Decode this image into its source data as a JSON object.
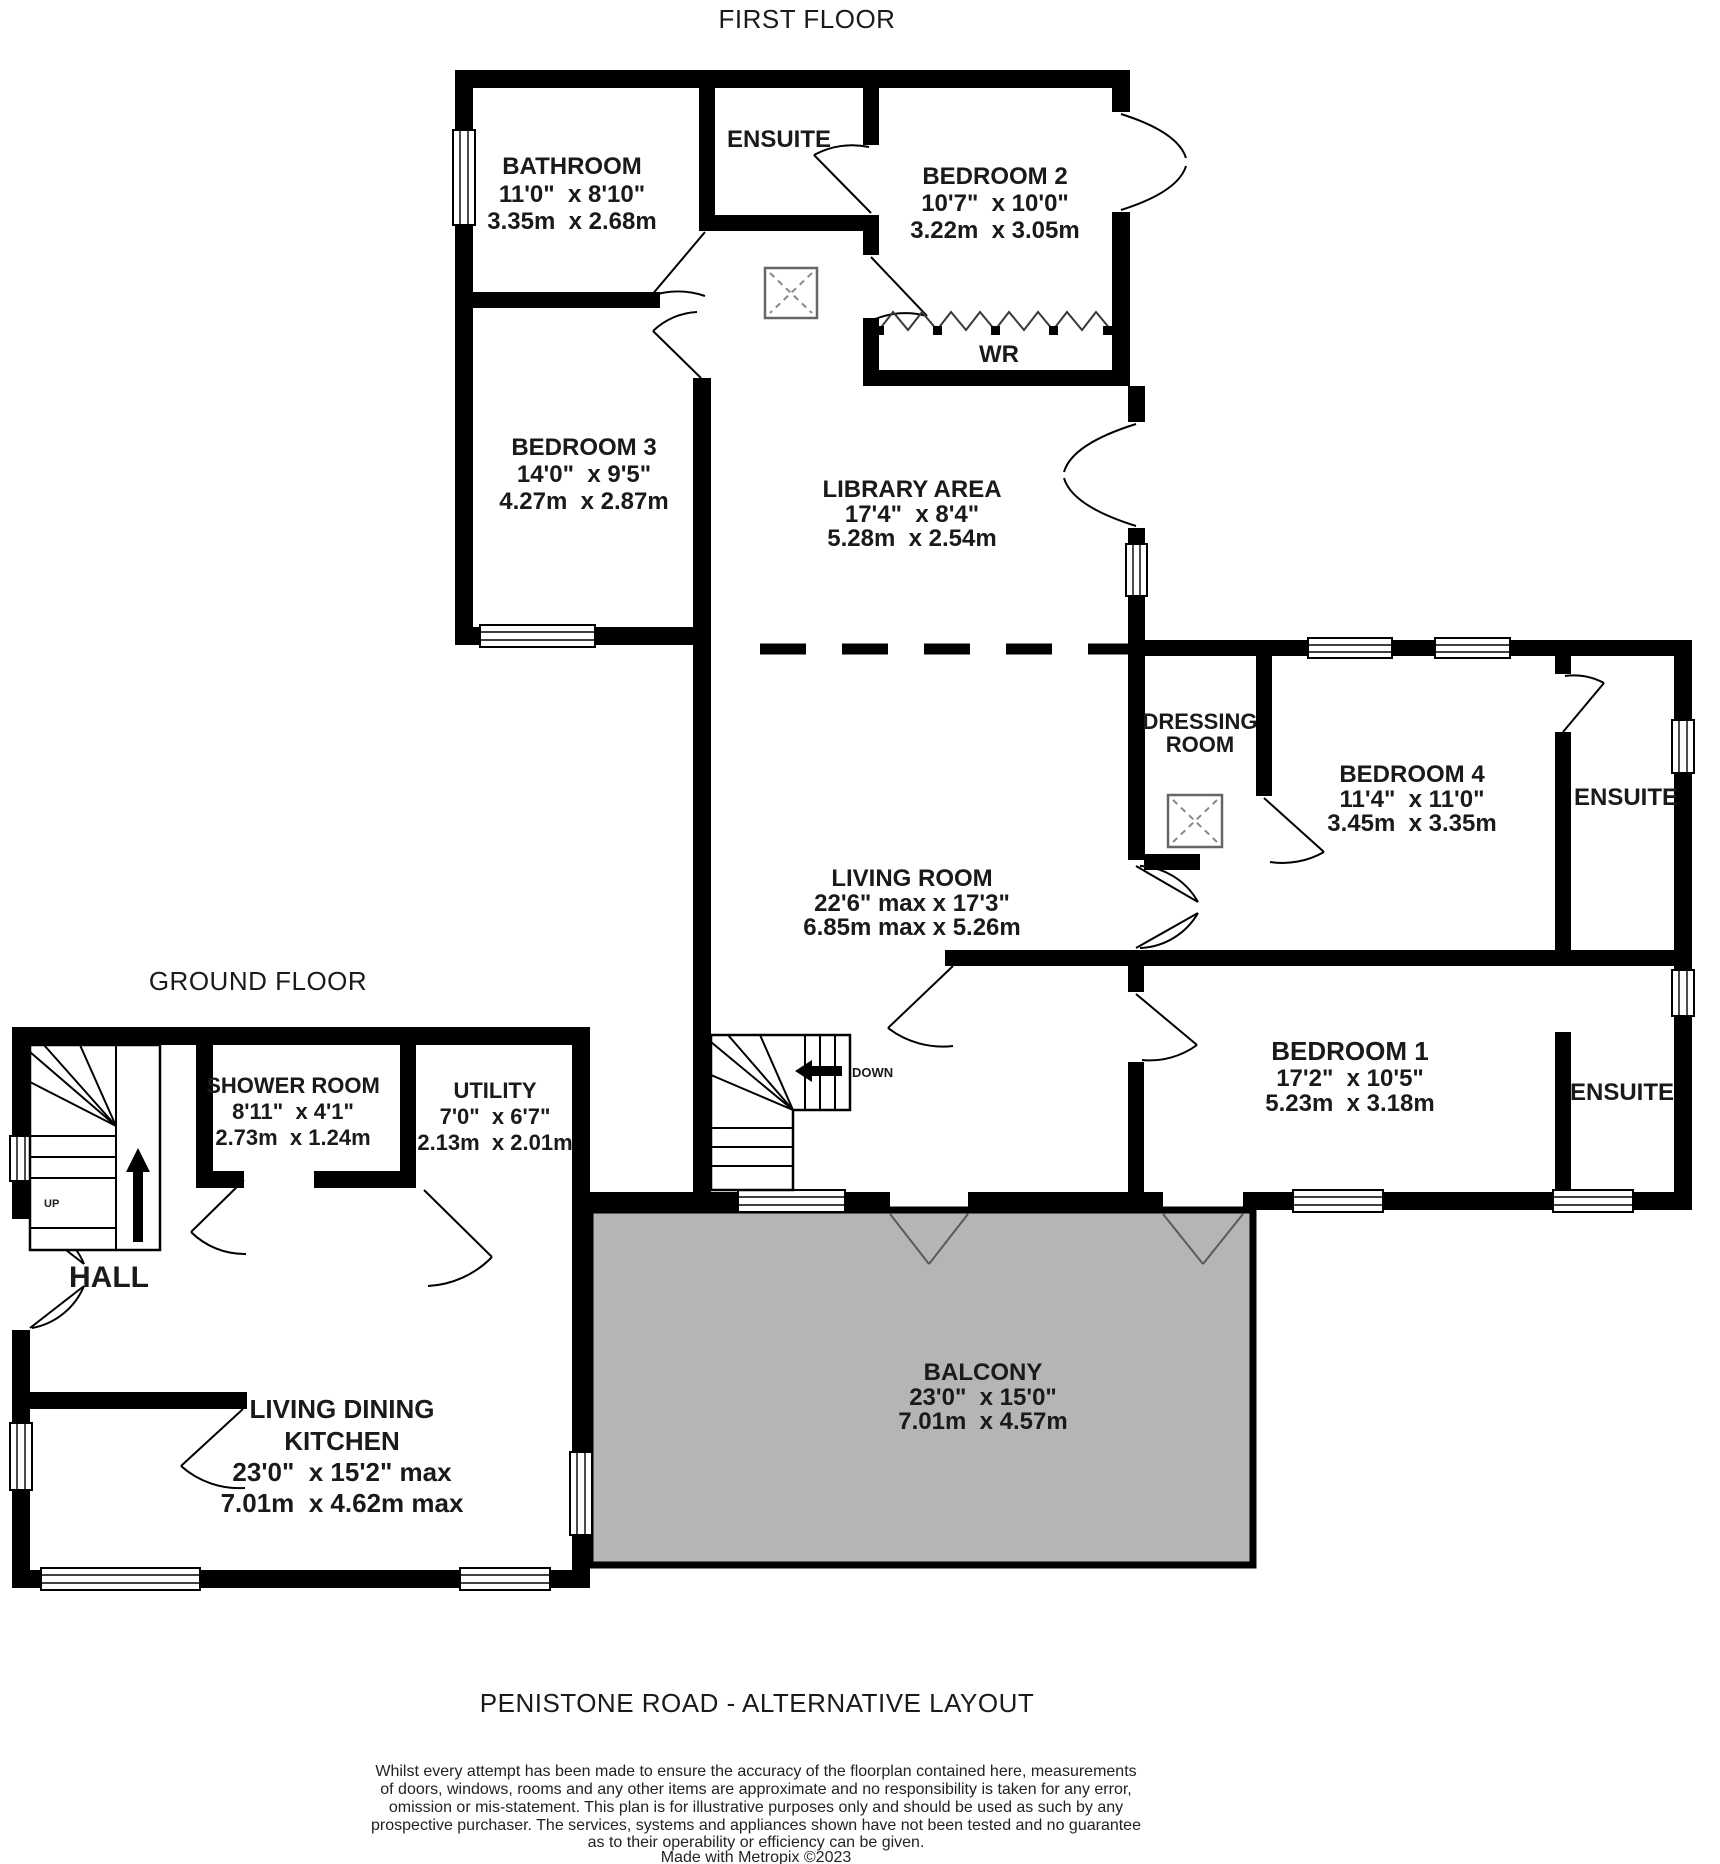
{
  "title": "PENISTONE ROAD - ALTERNATIVE LAYOUT",
  "credit": "Made with Metropix ©2023",
  "floors": {
    "first": {
      "label": "FIRST FLOOR"
    },
    "ground": {
      "label": "GROUND FLOOR"
    }
  },
  "rooms": {
    "bathroom": {
      "name": "BATHROOM",
      "ft": "11'0\"  x 8'10\"",
      "m": "3.35m  x 2.68m"
    },
    "ensuite_top": {
      "name": "ENSUITE"
    },
    "bedroom2": {
      "name": "BEDROOM 2",
      "ft": "10'7\"  x 10'0\"",
      "m": "3.22m  x 3.05m"
    },
    "wr": {
      "name": "WR"
    },
    "bedroom3": {
      "name": "BEDROOM 3",
      "ft": "14'0\"  x 9'5\"",
      "m": "4.27m  x 2.87m"
    },
    "library": {
      "name": "LIBRARY AREA",
      "ft": "17'4\"  x 8'4\"",
      "m": "5.28m  x 2.54m"
    },
    "dressing": {
      "name_line1": "DRESSING",
      "name_line2": "ROOM"
    },
    "bedroom4": {
      "name": "BEDROOM 4",
      "ft": "11'4\"  x 11'0\"",
      "m": "3.45m  x 3.35m"
    },
    "ensuite_bed4": {
      "name": "ENSUITE"
    },
    "living_room": {
      "name": "LIVING ROOM",
      "ft": "22'6\" max x 17'3\"",
      "m": "6.85m max x 5.26m"
    },
    "bedroom1": {
      "name": "BEDROOM 1",
      "ft": "17'2\"  x 10'5\"",
      "m": "5.23m  x 3.18m"
    },
    "ensuite_bed1": {
      "name": "ENSUITE"
    },
    "balcony": {
      "name": "BALCONY",
      "ft": "23'0\"  x 15'0\"",
      "m": "7.01m  x 4.57m"
    },
    "shower_room": {
      "name": "SHOWER ROOM",
      "ft": "8'11\"  x 4'1\"",
      "m": "2.73m  x 1.24m"
    },
    "utility": {
      "name": "UTILITY",
      "ft": "7'0\"  x 6'7\"",
      "m": "2.13m  x 2.01m"
    },
    "hall": {
      "name": "HALL"
    },
    "kitchen": {
      "name_line1": "LIVING DINING",
      "name_line2": "KITCHEN",
      "ft": "23'0\"  x 15'2\" max",
      "m": "7.01m  x 4.62m max"
    }
  },
  "stairs": {
    "down": "DOWN",
    "up": "UP"
  },
  "disclaimer": {
    "line1": "Whilst every attempt has been made to ensure the accuracy of the floorplan contained here, measurements",
    "line2": "of doors, windows, rooms and any other items are approximate and no responsibility is taken for any error,",
    "line3": "omission or mis-statement. This plan is for illustrative purposes only and should be used as such by any",
    "line4": "prospective purchaser. The services, systems and appliances shown have not been tested and no guarantee",
    "line5": "as to their operability or efficiency can be given."
  },
  "colors": {
    "wall": "#000000",
    "balcony_fill": "#b5b5b5",
    "text": "#1a1a1a"
  }
}
